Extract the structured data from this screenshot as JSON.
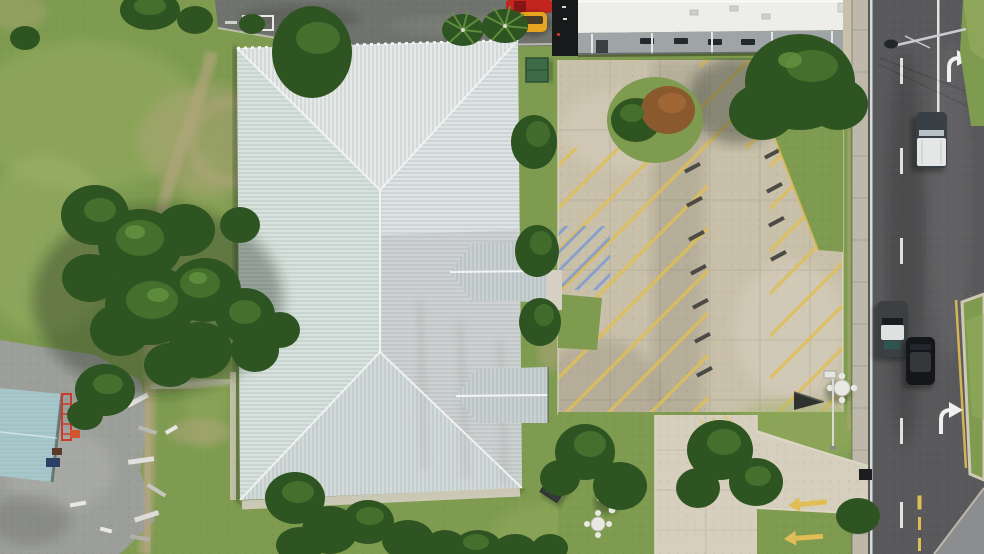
{
  "meta": {
    "description": "Aerial drone photo of a commercial property: large white hip-roof building with two gabled entry porticos, beige concrete parking lot with yellow angled stripes and blue handicap hatching, exit driveway with yellow arrows leading to a two-lane road on the right with passing vehicles, lawns with large trees on the left, small teal-roof outbuilding with gravel yard and debris at lower left, and a neighboring white flat-roof building with a dark asphalt drive and parked red and orange cars at top."
  },
  "scene": {
    "objects": [
      "grass-field",
      "dirt-path",
      "asphalt-drive-top",
      "soccer-goal",
      "parked-car-red",
      "parked-car-orange",
      "palm-tree",
      "neighbor-building-roof",
      "neighbor-building-wall",
      "dumpster",
      "main-building-roof",
      "roof-gable-upper",
      "roof-gable-lower",
      "shrub-row",
      "parking-lot",
      "parking-stripes",
      "handicap-hatching",
      "wheel-stops",
      "grass-wedge",
      "grass-island",
      "picnic-table",
      "ground-solar-panel",
      "a-frame-sign",
      "sign-post",
      "exit-driveway",
      "yellow-exit-arrows",
      "sidewalk",
      "roadway",
      "lane-markings",
      "turn-arrow-marking",
      "white-pickup-truck",
      "gray-pickup-truck",
      "black-suv",
      "median-island",
      "street-light",
      "utility-box",
      "teal-roof-building",
      "ladder",
      "gravel-yard",
      "debris-pile",
      "tree"
    ]
  },
  "colors": {
    "grass-base": "#7E9B50",
    "grass-light": "#9BB162",
    "grass-pale": "#ADBF74",
    "dirt": "#B3A67E",
    "tree-dark": "#2E5421",
    "tree-mid": "#456F2D",
    "tree-light": "#649240",
    "tree-rust": "#8A5A2E",
    "asphalt-top": "#70726D",
    "parking-concrete": "#C9C0AA",
    "concrete-light": "#D6CFBD",
    "stripe-yellow": "#E0BE55",
    "handicap-blue": "#7E9BD0",
    "curb-light": "#DCD6C4",
    "roof-west": "#D7E2DC",
    "roof-north": "#E4E8E7",
    "roof-east": "#DEE3E3",
    "roof-south": "#D3DADA",
    "roof-gable": "#C9D0D1",
    "roof-ridge": "#F1F4F3",
    "neighbor-roof": "#EDEDE9",
    "neighbor-wall": "#9FA5A6",
    "dark-gap": "#17191A",
    "sidewalk": "#BDB8A9",
    "road-asphalt": "#59595B",
    "marking-white": "#EFF1F0",
    "median-concrete": "#8B8D8E",
    "teal-roof": "#A6C8CC",
    "gravel": "#9C9E99",
    "car-red": "#C2241E",
    "car-orange": "#E6A41F",
    "truck-white": "#E5E7E7",
    "truck-cab": "#394045",
    "vehicle-black": "#141619",
    "vehicle-gray": "#3C4043"
  }
}
